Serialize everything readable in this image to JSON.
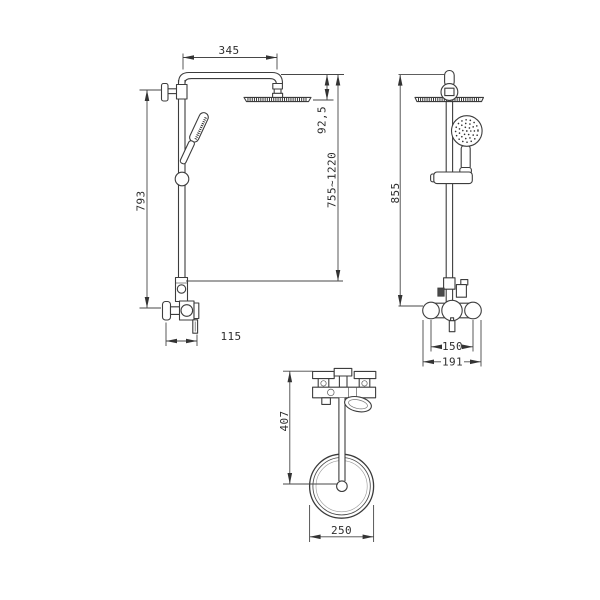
{
  "meta": {
    "drawing_type": "shower-column-orthographic-views",
    "background_color": "#ffffff",
    "line_color": "#3d3d3d"
  },
  "dimensions": {
    "arm_length": "345",
    "head_drop": "92,5",
    "adjustable_height": "755~1220",
    "bracket_to_valve_height": "793",
    "wall_projection": "115",
    "overall_height": "855",
    "inlet_center_distance": "150",
    "valve_overall_width": "191",
    "wall_to_head_center": "407",
    "head_diameter": "250"
  }
}
